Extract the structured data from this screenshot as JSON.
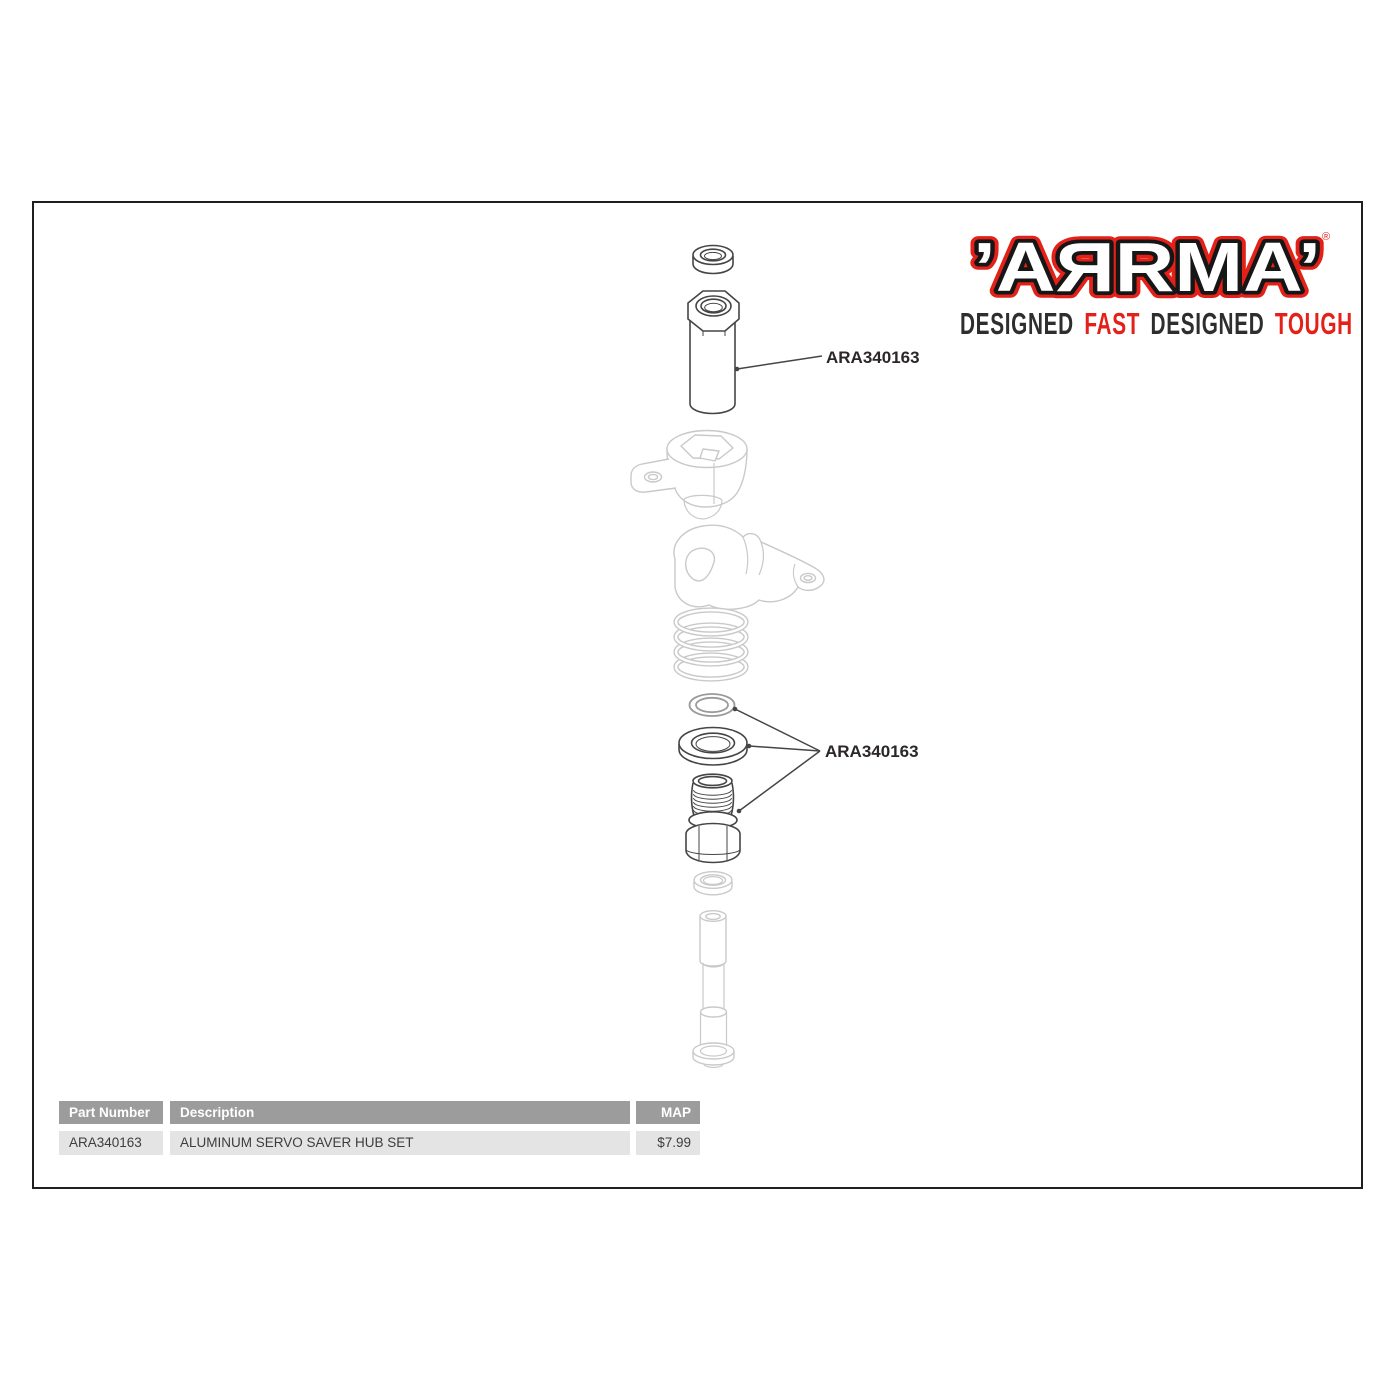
{
  "logo": {
    "brand_display": "’AЯRMA’",
    "registered": "®",
    "tagline": {
      "words": [
        {
          "text": "DESIGNED"
        },
        {
          "text": "FAST"
        },
        {
          "text": "DESIGNED"
        },
        {
          "text": "TOUGH"
        }
      ]
    },
    "colors": {
      "red": "#e32119",
      "dark": "#2e2e2e"
    }
  },
  "diagram": {
    "callouts": [
      {
        "text": "ARA340163",
        "points_to": "aluminum servo post"
      },
      {
        "text": "ARA340163",
        "points_to": "ring, washer and threaded hub"
      }
    ],
    "parts": [
      "top bushing",
      "aluminum servo post",
      "servo saver horn",
      "servo saver arm",
      "spring",
      "o-ring",
      "washer",
      "threaded hub nut",
      "small bushing",
      "stepped screw post"
    ]
  },
  "table": {
    "headers": [
      "Part Number",
      "Description",
      "MAP"
    ],
    "rows": [
      {
        "part_number": "ARA340163",
        "description": "ALUMINUM SERVO SAVER HUB SET",
        "map": "$7.99"
      }
    ],
    "colors": {
      "header_bg": "#9c9c9c",
      "row_bg": "#e4e4e4"
    }
  }
}
